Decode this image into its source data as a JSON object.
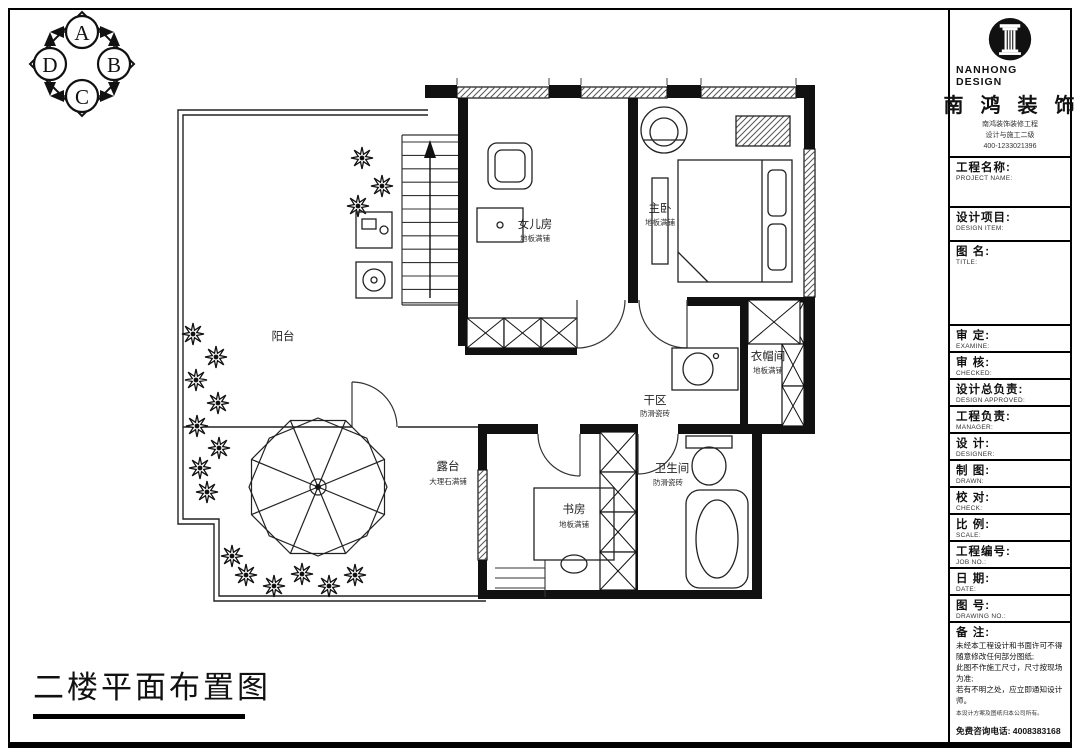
{
  "sheet": {
    "title": "二楼平面布置图"
  },
  "compass": {
    "n": "A",
    "e": "B",
    "s": "C",
    "w": "D"
  },
  "brand": {
    "logo_en": "NANHONG DESIGN",
    "logo_cn": "南 鸿 装 饰",
    "tagline1": "南鸿装饰装修工程",
    "tagline2": "设计与施工二级",
    "tagline3": "400-1233021396"
  },
  "titleblock": {
    "sections": [
      {
        "label": "工程名称:",
        "sub": "PROJECT NAME:"
      },
      {
        "label": "设计项目:",
        "sub": "DESIGN ITEM:"
      },
      {
        "label": "图  名:",
        "sub": "TITLE:"
      }
    ],
    "fields": [
      {
        "label": "审  定:",
        "sub": "EXAMINE:"
      },
      {
        "label": "审  核:",
        "sub": "CHECKED:"
      },
      {
        "label": "设计总负责:",
        "sub": "DESIGN APPROVED:"
      },
      {
        "label": "工程负责:",
        "sub": "MANAGER:"
      },
      {
        "label": "设  计:",
        "sub": "DESIGNER:"
      },
      {
        "label": "制  图:",
        "sub": "DRAWN:"
      },
      {
        "label": "校  对:",
        "sub": "CHECK:"
      },
      {
        "label": "比  例:",
        "sub": "SCALE:"
      },
      {
        "label": "工程编号:",
        "sub": "JOB NO.:"
      },
      {
        "label": "日  期:",
        "sub": "DATE:"
      },
      {
        "label": "图  号:",
        "sub": "DRAWING NO.:"
      }
    ],
    "notes": {
      "title": "备  注:",
      "lines": [
        "未经本工程设计和书面许可不得",
        "随意修改任何部分图纸;",
        "此图不作施工尺寸，尺寸按现场",
        "为准;",
        "若有不明之处，应立即通知设计",
        "师。"
      ],
      "small": "本设计方案及图纸归本公司所有。",
      "hotline": "免费咨询电话: 4008383168"
    }
  },
  "plan": {
    "rooms": [
      {
        "name": "女儿房",
        "sub": "地板满铺"
      },
      {
        "name": "主卧",
        "sub": "地板满铺"
      },
      {
        "name": "阳台",
        "sub": ""
      },
      {
        "name": "衣帽间",
        "sub": "地板满铺"
      },
      {
        "name": "干区",
        "sub": "防滑瓷砖"
      },
      {
        "name": "卫生间",
        "sub": "防滑瓷砖"
      },
      {
        "name": "书房",
        "sub": "地板满铺"
      },
      {
        "name": "露台",
        "sub": "大理石满铺"
      }
    ]
  }
}
